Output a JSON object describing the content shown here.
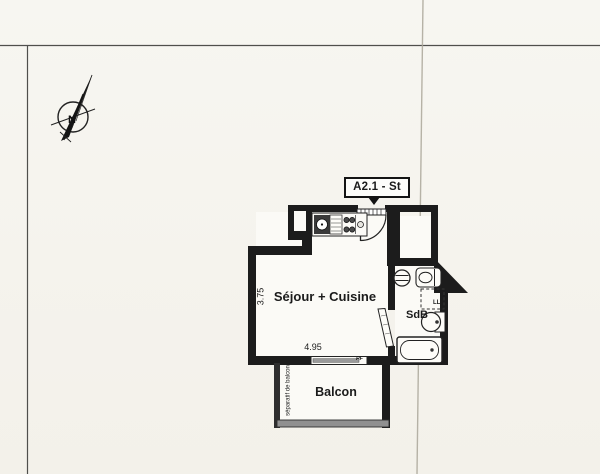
{
  "document": {
    "kind": "scanned floor plan"
  },
  "compass": {
    "north_label": "N"
  },
  "unit_tag": {
    "label": "A2.1 - St"
  },
  "rooms": {
    "living_kitchen": {
      "label": "Séjour + Cuisine"
    },
    "bathroom": {
      "label": "SdB"
    },
    "balcony": {
      "label": "Balcon"
    }
  },
  "dimensions": {
    "living_width_m": "4.95",
    "living_depth_m": "3.75"
  },
  "annotations": {
    "balcony_separator": "séparatif de balcon",
    "french_window": "PF",
    "washing_machine": "LL"
  },
  "colors": {
    "wall": "#1c1c1c",
    "paper": "#f6f4ee",
    "floor": "#fbfaf6",
    "railing": "#909090",
    "crease": "#aba79a",
    "scan_border": "#4f4f4c"
  },
  "icons": {
    "north_arrow": "north-arrow-icon",
    "sink": "kitchen-sink-icon",
    "hob": "hob-burners-icon",
    "entry_door": "entry-door-swing-icon",
    "bathroom_door": "bathroom-door-leaf-icon",
    "toilet": "toilet-icon",
    "washbasin": "washbasin-icon",
    "bathtub": "bathtub-icon",
    "vent": "vent-circle-icon",
    "window": "french-window-icon"
  }
}
